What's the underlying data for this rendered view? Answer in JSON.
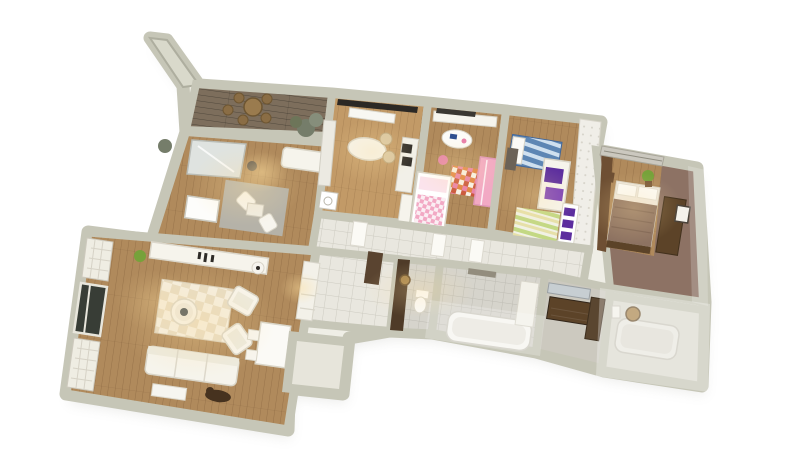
{
  "scene": {
    "type": "3d-apartment-floor-plan-cutaway-render",
    "background": "#ffffff",
    "view_rotation_deg": 8
  },
  "palette": {
    "wall": "#c6c6b7",
    "wall_light": "#d9d9cb",
    "wood": "#b08a5c",
    "wood_light": "#c29a67",
    "wood_dark": "#8a6a44",
    "balcony_wood": "#7d6e5c",
    "tile": "#e9e7df",
    "tile_grey": "#d6d4cc",
    "tile_fade": "#ccc9bf",
    "tile_warm": "#dcdacf",
    "taupe_wall": "#8d7264",
    "dark_wood": "#5c4328",
    "headboard_wood": "#6e4f33",
    "white_furniture": "#f6f4ec",
    "grey_rug": "#b5b2a8",
    "beige_rug_a": "#e6dbc4",
    "beige_rug_b": "#f4efe3",
    "kids_orange": "#e0813f",
    "kids_red": "#c9563a",
    "kids_pink": "#e87fa8",
    "pink": "#f2a9c4",
    "pink_dark": "#e583a9",
    "blue": "#5d86b4",
    "blue_light": "#cfe0ef",
    "purple": "#5c2d9e",
    "purple_light": "#7a3fb8",
    "rug_green": "#c3d884",
    "rug_yellow": "#e6e0a8",
    "plant_green": "#76a23a",
    "bush_grey_green": "#757d6a",
    "gold": "#a9854b",
    "accent_dark_brown": "#4f3b28",
    "entry_door_brown": "#5a4430",
    "blanket_brown": "#8d7261",
    "glass_dark": "#383d36",
    "vase_teal": "#3f4a52",
    "sculpture_brown": "#46321f",
    "warm_light": "#ffdf9e"
  },
  "rooms": [
    {
      "id": "balcony",
      "name": "Balcony terrace",
      "floor": "dark rustic wood planks",
      "floor_color": "#7d6e5c",
      "items": [
        "round wooden table",
        "wooden stools",
        "potted plants",
        "diagonal privacy wall"
      ]
    },
    {
      "id": "study",
      "name": "Study / family room",
      "floor": "wood planks",
      "floor_color": "#b08a5c",
      "items": [
        "mirrored wardrobe",
        "white sofa",
        "radiator",
        "grey rug",
        "two white chairs",
        "side table",
        "desk chair"
      ]
    },
    {
      "id": "kitchen",
      "name": "Kitchen",
      "floor": "wood planks",
      "floor_color": "#c29a67",
      "items": [
        "upper cabinets with dark hood",
        "vent unit",
        "side cabinets",
        "oval island table",
        "two wicker chairs",
        "tall oven column",
        "counter",
        "washing machine"
      ]
    },
    {
      "id": "kids",
      "name": "Children's room",
      "floor": "wood planks",
      "floor_color": "#b08a5c",
      "items": [
        "desk shelf",
        "oval play table with toys",
        "pink stool",
        "colorful checkered rug",
        "cot with checkered blanket",
        "pink wardrobe"
      ]
    },
    {
      "id": "teen",
      "name": "Teen bedroom",
      "floor": "wood planks",
      "floor_color": "#b08a5c",
      "items": [
        "bed with blue striped bedding",
        "white wardrobe with purple posters",
        "striped rug",
        "bookshelf with purple books",
        "dark desk",
        "quilted accent wall"
      ]
    },
    {
      "id": "master",
      "name": "Master bedroom",
      "floor": "wood planks",
      "floor_color": "#b08a5c",
      "wall_color": "#8d7264",
      "items": [
        "double bed with brown blanket",
        "white pillows",
        "wood headboard wall",
        "nightstand",
        "green plant",
        "dark wardrobe",
        "picture frame",
        "window blinds"
      ]
    },
    {
      "id": "corridor",
      "name": "Hallway",
      "floor": "white tiles",
      "floor_color": "#e9e7df",
      "items": [
        "white interior doors"
      ]
    },
    {
      "id": "entry",
      "name": "Entry hall",
      "floor": "white tiles",
      "floor_color": "#e9e7df",
      "items": [
        "brown entry door"
      ]
    },
    {
      "id": "wc",
      "name": "WC",
      "floor": "grey tiles",
      "floor_color": "#d6d4cc",
      "items": [
        "dark accent wall",
        "toilet",
        "round gold mirror"
      ]
    },
    {
      "id": "bath",
      "name": "Bathroom",
      "floor": "grey tiles",
      "floor_color": "#d6d4cc",
      "items": [
        "bathtub",
        "vanity counter",
        "towel"
      ]
    },
    {
      "id": "dressing",
      "name": "Dressing room",
      "floor": "grey tiles",
      "floor_color": "#ccc9bf",
      "items": [
        "wall mirror",
        "dark wood dresser",
        "dark cabinet"
      ]
    },
    {
      "id": "ensuite",
      "name": "En-suite bathroom",
      "floor": "light tiles",
      "floor_color": "#dcdacf",
      "items": [
        "bathtub",
        "round wall ornament",
        "towel rail"
      ]
    },
    {
      "id": "living",
      "name": "Living room",
      "floor": "wood planks",
      "floor_color": "#b08a5c",
      "items": [
        "panoramic lattice windows",
        "sideboard with candles",
        "potted plant",
        "checkered rug",
        "round coffee table with teal vase",
        "two armchairs",
        "white sofa",
        "floor mat",
        "dining table with chairs",
        "floor lamp",
        "shelf unit",
        "dark sculpture"
      ]
    },
    {
      "id": "alcove",
      "name": "Entry alcove",
      "floor": "tiles",
      "floor_color": "#e7e5db",
      "items": []
    }
  ]
}
